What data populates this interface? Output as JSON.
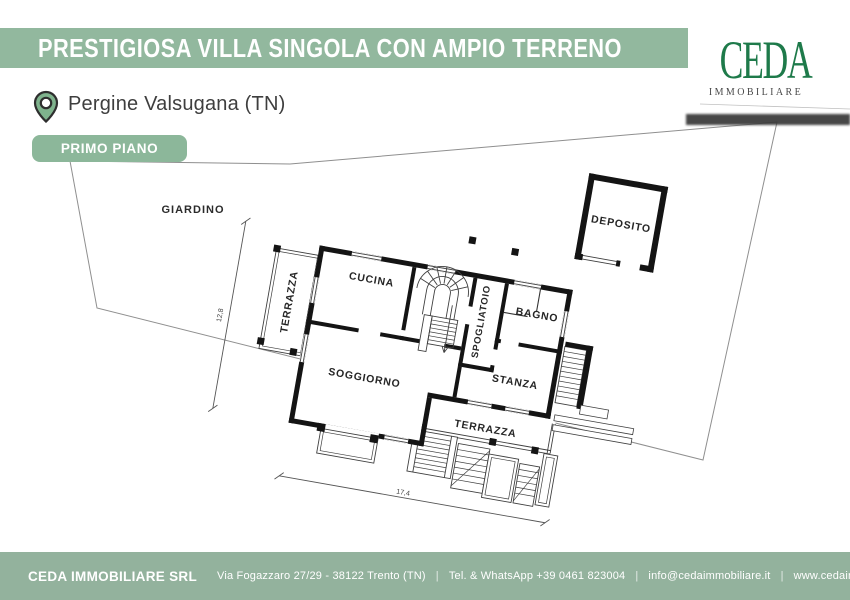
{
  "header": {
    "title": "PRESTIGIOSA VILLA SINGOLA CON AMPIO TERRENO",
    "logo": {
      "brand": "CEDA",
      "subtitle": "IMMOBILIARE"
    }
  },
  "location": {
    "name": "Pergine Valsugana (TN)"
  },
  "floor_badge": {
    "label": "PRIMO PIANO"
  },
  "plan": {
    "rooms": [
      {
        "name": "giardino",
        "label": "GIARDINO"
      },
      {
        "name": "terrazza-ovest",
        "label": "TERRAZZA"
      },
      {
        "name": "cucina",
        "label": "CUCINA"
      },
      {
        "name": "spogliatoio",
        "label": "SPOGLIATOIO"
      },
      {
        "name": "bagno",
        "label": "BAGNO"
      },
      {
        "name": "soggiorno",
        "label": "SOGGIORNO"
      },
      {
        "name": "stanza",
        "label": "STANZA"
      },
      {
        "name": "terrazza-sud",
        "label": "TERRAZZA"
      },
      {
        "name": "deposito",
        "label": "DEPOSITO"
      }
    ],
    "dimensions": {
      "depth": "12,8",
      "width": "17,4"
    }
  },
  "footer": {
    "company": "CEDA IMMOBILIARE SRL",
    "address": "Via Fogazzaro 27/29 - 38122 Trento (TN)",
    "phone": "Tel. & WhatsApp +39 0461 823004",
    "email": "info@cedaimmobiliare.it",
    "website": "www.cedaimmobiliare.it",
    "separator": "|"
  },
  "colors": {
    "banner_green": "#92b89e",
    "badge_green": "#8cb79a",
    "footer_green": "#93b29d",
    "logo_green": "#1e7a4a",
    "wall_black": "#141414"
  }
}
